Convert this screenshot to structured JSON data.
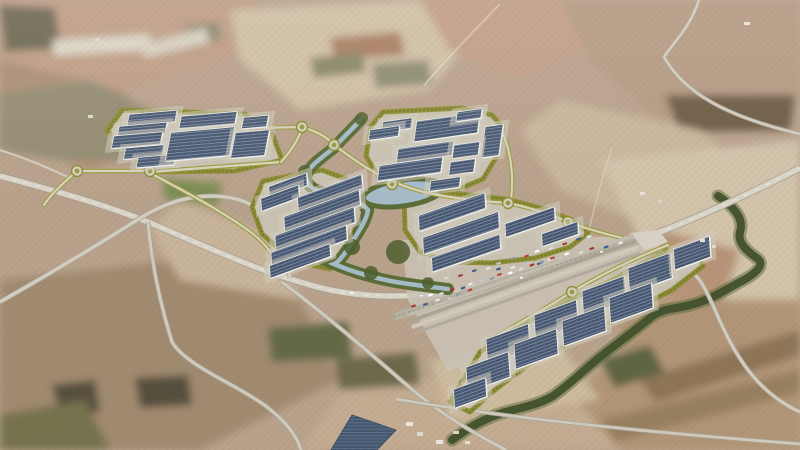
{
  "scene": {
    "description": "aerial-render-of-logistics-park-masterplan-over-farmland",
    "canvas": {
      "w": 800,
      "h": 450
    },
    "palette": {
      "base": "#b9a28c",
      "road": "#d6d1c4",
      "road_casing": "#a39d8e",
      "parcel_fill": "#c9c2b2",
      "parcel_border": "#8a8c31",
      "roof": "#47566e",
      "roof_line": "#8b9cb3",
      "water": "#a4bac7",
      "riparian": "#5c6c36",
      "arroyo": "#41512c",
      "access_casing": "#9b9c39"
    },
    "fields": [
      {
        "name": "field-tl-pink",
        "points": "0,0 260,0 230,60 120,90 0,70",
        "fill": "#bf9d85"
      },
      {
        "name": "field-tl-brown",
        "points": "0,60 120,90 180,140 90,170 0,140",
        "fill": "#ab8f74"
      },
      {
        "name": "field-tl-olive",
        "points": "0,95 90,80 170,120 150,160 60,160 0,150",
        "fill": "#968f75",
        "pattern": "dots"
      },
      {
        "name": "field-tl-corner-grove",
        "points": "0,5 55,8 60,48 5,52",
        "fill": "#6f6a52",
        "pattern": "dots"
      },
      {
        "name": "field-tc-cream",
        "points": "230,10 420,0 470,40 430,90 300,110 240,60",
        "fill": "#d0bfa4"
      },
      {
        "name": "field-tc-pink",
        "points": "420,0 560,0 600,40 520,80 450,50",
        "fill": "#c29d86"
      },
      {
        "name": "field-tc-rust",
        "points": "330,38 400,32 405,55 335,60",
        "fill": "#a97f62"
      },
      {
        "name": "field-tc-sage1",
        "points": "185,25 218,22 222,40 188,44",
        "fill": "#8d8a70"
      },
      {
        "name": "field-tc-sage2",
        "points": "372,64 428,60 432,84 376,88",
        "fill": "#8f8c72"
      },
      {
        "name": "field-tc-sage3",
        "points": "310,58 362,52 366,72 314,78",
        "fill": "#8a8768"
      },
      {
        "name": "field-tr-mottled",
        "points": "560,0 800,0 800,95 660,120 590,60",
        "fill": "#b49a82"
      },
      {
        "name": "field-tr-dark",
        "points": "665,95 795,95 790,130 680,132",
        "fill": "#6e5b44"
      },
      {
        "name": "field-r-pale",
        "points": "560,100 700,130 760,180 660,230 560,190 520,130",
        "fill": "#cbb89e",
        "pattern": "rows"
      },
      {
        "name": "field-r-cream",
        "points": "600,160 800,140 800,300 720,300 640,240",
        "fill": "#d2c3aa"
      },
      {
        "name": "field-r-pink",
        "points": "660,230 740,250 720,310 650,290",
        "fill": "#b79478"
      },
      {
        "name": "field-br-striped",
        "points": "620,300 800,300 800,450 560,450 560,400 620,360",
        "fill": "#b39878",
        "pattern": "rows"
      },
      {
        "name": "field-br-strip1",
        "points": "640,380 800,330 800,355 655,402",
        "fill": "#8d7456"
      },
      {
        "name": "field-br-strip2",
        "points": "600,420 800,370 800,392 615,442",
        "fill": "#97805f"
      },
      {
        "name": "field-bc",
        "points": "350,380 560,380 620,450 300,450",
        "fill": "#c3ac92"
      },
      {
        "name": "field-bc-pale",
        "points": "430,360 560,345 600,400 450,420",
        "fill": "#cdbb9f"
      },
      {
        "name": "field-bc-darkveg",
        "points": "600,360 650,345 665,372 615,388",
        "fill": "#5f6542"
      },
      {
        "name": "field-bl-brown",
        "points": "0,280 180,260 300,300 340,380 200,450 0,450",
        "fill": "#a08a70"
      },
      {
        "name": "field-bl-blob1",
        "points": "52,385 95,380 100,412 60,415",
        "fill": "#57503e"
      },
      {
        "name": "field-bl-blob2",
        "points": "135,378 188,375 192,405 140,408",
        "fill": "#57503e"
      },
      {
        "name": "field-bl-grove",
        "points": "0,415 85,400 110,450 0,450",
        "fill": "#77754f",
        "pattern": "dots"
      },
      {
        "name": "field-c-mid",
        "points": "180,200 280,240 300,300 180,280 150,230",
        "fill": "#c8b49a"
      },
      {
        "name": "field-c-green-crop",
        "points": "163,178 222,183 218,205 165,200",
        "fill": "#7b8d52"
      },
      {
        "name": "field-c-darkolive1",
        "points": "268,328 348,322 352,358 272,362",
        "fill": "#656a47",
        "pattern": "dots"
      },
      {
        "name": "field-c-darkolive2",
        "points": "335,360 415,352 420,385 340,390",
        "fill": "#6f6a4d",
        "pattern": "dots"
      },
      {
        "name": "strip-airfield-1",
        "points": "52,40 150,34 152,50 54,56",
        "fill": "#dcd5c4"
      },
      {
        "name": "strip-airfield-2",
        "points": "140,45 205,28 210,42 145,58",
        "fill": "#d8d0bf"
      }
    ],
    "roads": [
      {
        "name": "highway-main",
        "d": "M 0,176 C 60,192 105,205 148,222 C 210,248 265,275 330,290 C 395,303 455,293 515,279 C 560,268 600,252 638,240 C 690,222 745,196 800,168",
        "w": 5.5,
        "fill": "#d8d3c6",
        "casing": "#a39d8e",
        "dash": true
      },
      {
        "name": "road-southwest",
        "d": "M 0,302 C 60,268 105,240 142,217 C 175,197 205,193 232,198 C 258,203 272,220 282,242 C 287,254 289,266 290,278",
        "w": 3.4,
        "fill": "#d3cdc0",
        "casing": "#a8a294"
      },
      {
        "name": "road-south-left",
        "d": "M 148,222 C 152,268 162,310 172,342 C 186,366 238,385 267,407 C 285,421 296,434 301,450",
        "w": 3,
        "fill": "#d0cabd",
        "casing": "#a8a294"
      },
      {
        "name": "road-south-center",
        "d": "M 282,282 C 322,312 362,346 402,381 C 440,414 470,431 506,450",
        "w": 3,
        "fill": "#d0cabd",
        "casing": "#a8a294"
      },
      {
        "name": "road-bottom-straight",
        "d": "M 396,399 C 520,420 660,433 800,444",
        "w": 2.6,
        "fill": "#d0cabd",
        "casing": "#aaa496"
      },
      {
        "name": "road-southeast",
        "d": "M 640,240 C 663,252 690,266 701,282 C 714,303 722,332 741,360 C 756,383 776,401 800,412",
        "w": 3,
        "fill": "#d2ccbf",
        "casing": "#a8a294"
      },
      {
        "name": "road-northeast",
        "d": "M 699,0 C 690,28 672,44 664,57 C 684,92 724,116 800,134",
        "w": 2.4,
        "fill": "#d2ccbf",
        "casing": "#aaa496"
      },
      {
        "name": "road-left-connector",
        "d": "M 0,150 C 25,158 45,166 70,178",
        "w": 2.2,
        "fill": "#d0cabd"
      },
      {
        "name": "track-north",
        "d": "M 500,4 C 470,35 445,60 424,86",
        "w": 1.6,
        "fill": "#ddd6c6",
        "opacity": 0.7
      },
      {
        "name": "track-east",
        "d": "M 612,148 C 600,185 590,220 585,252",
        "w": 1.4,
        "fill": "#ddd6c6",
        "opacity": 0.6
      }
    ],
    "rail": {
      "name": "rail-corridor",
      "d": "M 394,317 C 470,292 560,262 648,238",
      "w": 8,
      "fill": "#b6b0a2",
      "line": "#948e7e"
    },
    "terminal_pad": {
      "name": "terminal-apron",
      "points": "402,240 648,236 662,248 470,362 448,372 408,300",
      "fill": "#c9c3b5"
    },
    "junction_pad": {
      "name": "junction-pad",
      "points": "630,233 658,230 668,242 645,250",
      "fill": "#d6d1c4"
    },
    "parcels": [
      {
        "name": "parcel-northwest",
        "points": "122,110 245,114 272,133 282,160 235,171 148,172 107,131"
      },
      {
        "name": "parcel-north",
        "points": "383,112 462,108 492,115 503,128 497,156 483,179 459,189 420,192 382,183 366,156 371,126"
      },
      {
        "name": "parcel-center-west",
        "points": "263,181 322,170 346,179 357,199 344,226 351,248 330,269 295,262 262,234 252,207"
      },
      {
        "name": "parcel-center-east",
        "points": "404,197 450,193 505,199 545,209 576,222 588,233 570,247 535,258 492,263 450,262 420,252 405,230"
      },
      {
        "name": "parcel-southeast",
        "points": "450,402 480,352 520,326 570,300 620,276 668,250 697,252 703,266 672,290 624,315 576,340 528,365 492,392 470,412"
      }
    ],
    "river": {
      "name": "river",
      "band_d": "M 362,118 C 352,130 342,138 336,146 C 322,158 308,166 306,177 C 306,188 320,193 338,196 C 352,198 362,203 368,210 C 366,222 358,232 349,247 C 342,258 337,263 334,264 C 348,270 368,277 396,282 C 414,285 432,287 448,289",
      "pond": {
        "cx": 403,
        "cy": 193,
        "rx": 40,
        "ry": 13,
        "rot": -8
      },
      "trees": [
        {
          "x": 305,
          "y": 172,
          "r": 7
        },
        {
          "x": 340,
          "y": 196,
          "r": 6
        },
        {
          "x": 352,
          "y": 247,
          "r": 8
        },
        {
          "x": 371,
          "y": 273,
          "r": 7
        },
        {
          "x": 398,
          "y": 252,
          "r": 12
        },
        {
          "x": 428,
          "y": 283,
          "r": 6
        },
        {
          "x": 360,
          "y": 120,
          "r": 5
        }
      ]
    },
    "arroyo": {
      "name": "arroyo-stream",
      "d": "M 718,196 C 736,208 744,220 740,232 C 737,243 748,252 758,259 C 766,266 752,276 740,282 C 722,292 712,298 700,302 C 680,310 664,306 650,318 C 632,333 616,344 600,357 C 584,370 570,384 553,396 C 536,406 518,408 502,413 C 486,418 468,428 452,440"
    },
    "access_roads": [
      {
        "name": "access-west-link",
        "d": "M 77,171 C 64,182 52,193 44,205"
      },
      {
        "name": "access-roundabout-row",
        "d": "M 77,171 L 150,171"
      },
      {
        "name": "access-parcel-a-south",
        "d": "M 150,172 L 281,162"
      },
      {
        "name": "access-parcel-a-north",
        "d": "M 256,128 L 302,127 C 318,132 327,137 334,145"
      },
      {
        "name": "access-parcel-a-east",
        "d": "M 281,162 C 292,150 298,140 302,128"
      },
      {
        "name": "access-to-center",
        "d": "M 150,173 C 188,193 225,213 252,233 C 266,244 274,256 281,270"
      },
      {
        "name": "access-spine-east",
        "d": "M 334,145 C 352,158 370,172 392,181 C 412,190 430,194 450,197 C 470,200 490,202 508,203 C 532,208 552,215 568,222 C 588,229 605,234 622,238"
      },
      {
        "name": "access-parcel-b-east",
        "d": "M 502,131 C 511,152 514,176 511,199"
      },
      {
        "name": "access-parcel-e-spine",
        "d": "M 487,341 C 530,318 550,305 572,292 C 602,274 635,258 668,245"
      }
    ],
    "roundabouts": [
      {
        "cx": 77,
        "cy": 171
      },
      {
        "cx": 150,
        "cy": 171
      },
      {
        "cx": 256,
        "cy": 128
      },
      {
        "cx": 302,
        "cy": 127
      },
      {
        "cx": 334,
        "cy": 145
      },
      {
        "cx": 392,
        "cy": 184
      },
      {
        "cx": 508,
        "cy": 203
      },
      {
        "cx": 568,
        "cy": 222
      },
      {
        "cx": 572,
        "cy": 292
      }
    ],
    "buildings": {
      "legend": "cx,cy,w,h,rot",
      "items": [
        [
          152,
          118,
          48,
          11,
          -5
        ],
        [
          208,
          120,
          56,
          12,
          -5
        ],
        [
          142,
          130,
          48,
          11,
          -5
        ],
        [
          137,
          140,
          49,
          12,
          -5
        ],
        [
          144,
          152,
          39,
          11,
          -5
        ],
        [
          156,
          161,
          38,
          10,
          -5
        ],
        [
          200,
          144,
          64,
          28,
          -5
        ],
        [
          250,
          144,
          34,
          25,
          -5
        ],
        [
          255,
          122,
          25,
          11,
          -5
        ],
        [
          397,
          125,
          30,
          10,
          -8
        ],
        [
          384,
          133,
          30,
          10,
          -8
        ],
        [
          447,
          127,
          64,
          20,
          -8
        ],
        [
          469,
          115,
          25,
          9,
          -8
        ],
        [
          492,
          141,
          18,
          30,
          -8
        ],
        [
          425,
          152,
          56,
          14,
          -8
        ],
        [
          466,
          150,
          26,
          13,
          -8
        ],
        [
          410,
          169,
          64,
          15,
          -8
        ],
        [
          462,
          167,
          25,
          13,
          -8
        ],
        [
          445,
          184,
          30,
          10,
          -8
        ],
        [
          288,
          186,
          40,
          12,
          -20
        ],
        [
          280,
          198,
          40,
          12,
          -20
        ],
        [
          330,
          193,
          68,
          14,
          -20
        ],
        [
          322,
          211,
          80,
          15,
          -20
        ],
        [
          315,
          229,
          84,
          15,
          -20
        ],
        [
          309,
          246,
          80,
          14,
          -20
        ],
        [
          300,
          261,
          64,
          12,
          -20
        ],
        [
          452,
          212,
          70,
          15,
          -19
        ],
        [
          461,
          233,
          80,
          16,
          -19
        ],
        [
          466,
          253,
          72,
          14,
          -19
        ],
        [
          530,
          222,
          52,
          13,
          -19
        ],
        [
          560,
          234,
          38,
          12,
          -19
        ],
        [
          508,
          344,
          45,
          24,
          -20
        ],
        [
          556,
          320,
          45,
          24,
          -20
        ],
        [
          604,
          296,
          45,
          24,
          -20
        ],
        [
          650,
          273,
          45,
          24,
          -20
        ],
        [
          692,
          253,
          38,
          20,
          -20
        ],
        [
          488,
          372,
          45,
          24,
          -20
        ],
        [
          536,
          349,
          45,
          24,
          -20
        ],
        [
          584,
          326,
          45,
          24,
          -20
        ],
        [
          631,
          303,
          45,
          24,
          -20
        ],
        [
          470,
          393,
          34,
          18,
          -20
        ]
      ]
    },
    "terminal_strips": {
      "cx": 525,
      "cy": 287,
      "rot": -19.5,
      "strips": [
        {
          "dy": -14,
          "h": 3,
          "fill": "#c2bcae"
        },
        {
          "dy": -8,
          "h": 3.5,
          "fill": "#a9a396"
        },
        {
          "dy": -2,
          "h": 4,
          "fill": "#cfc9bb"
        },
        {
          "dy": 5,
          "h": 3,
          "fill": "#b1aa9c"
        }
      ],
      "len": 240
    },
    "truck_lines": [
      {
        "x1": 432,
        "y1": 296,
        "x2": 560,
        "y2": 257,
        "n": 14
      },
      {
        "x1": 448,
        "y1": 279,
        "x2": 590,
        "y2": 236,
        "n": 12
      },
      {
        "x1": 415,
        "y1": 307,
        "x2": 470,
        "y2": 291,
        "n": 6
      },
      {
        "x1": 500,
        "y1": 270,
        "x2": 620,
        "y2": 243,
        "n": 10
      }
    ],
    "truck_colors": [
      "#ffffff",
      "#d8dce1",
      "#a8332e",
      "#3a5a8c",
      "#e9ebee",
      "#c2c8cf",
      "#8c9aa8",
      "#b9432e"
    ],
    "solar_farm": {
      "name": "solar-farm",
      "points": "331,450 352,415 396,430 377,450",
      "fill": "#42586f"
    },
    "specks": [
      {
        "x": 406,
        "y": 422,
        "w": 7,
        "h": 4,
        "fill": "#e8e4da"
      },
      {
        "x": 417,
        "y": 432,
        "w": 6,
        "h": 4,
        "fill": "#ddd8cc"
      },
      {
        "x": 436,
        "y": 440,
        "w": 7,
        "h": 4,
        "fill": "#e8e4da"
      },
      {
        "x": 453,
        "y": 431,
        "w": 6,
        "h": 3,
        "fill": "#d8d3c6"
      },
      {
        "x": 465,
        "y": 441,
        "w": 5,
        "h": 3,
        "fill": "#e2ddd1"
      },
      {
        "x": 744,
        "y": 22,
        "w": 6,
        "h": 3,
        "fill": "#e6e2d8"
      },
      {
        "x": 640,
        "y": 192,
        "w": 5,
        "h": 3,
        "fill": "#e4e0d6"
      },
      {
        "x": 658,
        "y": 200,
        "w": 4,
        "h": 3,
        "fill": "#d8d3c7"
      },
      {
        "x": 700,
        "y": 239,
        "w": 5,
        "h": 3,
        "fill": "#e6e2d8"
      },
      {
        "x": 712,
        "y": 245,
        "w": 4,
        "h": 3,
        "fill": "#dddad0"
      },
      {
        "x": 95,
        "y": 38,
        "w": 5,
        "h": 3,
        "fill": "#dcd7ca"
      },
      {
        "x": 88,
        "y": 115,
        "w": 5,
        "h": 3,
        "fill": "#dcd7ca"
      },
      {
        "x": 350,
        "y": 292,
        "w": 3,
        "h": 1.5,
        "fill": "#ffffff"
      },
      {
        "x": 420,
        "y": 295,
        "w": 3,
        "h": 1.5,
        "fill": "#f4f2ea"
      },
      {
        "x": 520,
        "y": 277,
        "w": 3,
        "h": 1.5,
        "fill": "#ffffff"
      },
      {
        "x": 600,
        "y": 251,
        "w": 3,
        "h": 1.5,
        "fill": "#f4f2ea"
      }
    ]
  }
}
